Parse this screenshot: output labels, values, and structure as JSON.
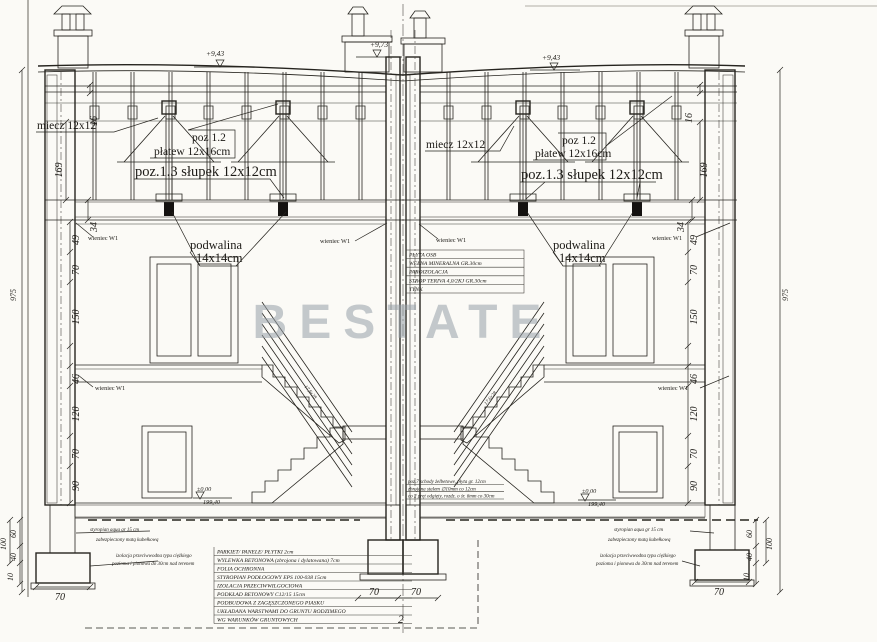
{
  "watermark": "BESTATE",
  "axis_label": "2",
  "levels": {
    "ridge": "+9,73",
    "eaves": "+9,43",
    "zero": "±0,00",
    "datum": "199,40"
  },
  "roof": {
    "miecz": "miecz 12x12",
    "poz": "poz 1.2",
    "platew": "płatew 12x16cm",
    "slupek": "poz.1.3 słupek 12x12cm"
  },
  "walls": {
    "podwalina": "podwalina",
    "podwalina_size": "14x14cm",
    "wieniec": "wieniec W1"
  },
  "ceiling_table": {
    "rows": [
      "PŁYTA OSB",
      "WEŁNA MINERALNA  GR.30cm",
      "PAROIZOLACJA",
      "STROP TERIVA 4,0/2KJ  GR.30cm",
      "TYNK"
    ]
  },
  "floor_table": {
    "rows": [
      "PARKIET/ PANELE/ PŁYTKI  2cm",
      "WYLEWKA BETONOWA (zbrojona i dylatowana) 7cm",
      "FOLIA OCHRONNA",
      "STYROPIAN PODŁOGOWY EPS 100-038  15cm",
      "IZOLACJA PRZECIWWILGOCIOWA",
      "PODKŁAD BETONOWY C12/15  15cm",
      "PODBUDOWA Z ZAGĘSZCZONEGO PIASKU",
      "UKŁADANA WARSTWAMI DO GRUNTU RODZIMEGO",
      "WG WARUNKÓW GRUNTOWYCH"
    ]
  },
  "stairs_note": {
    "lines": [
      "poz.7 schody żelbetowe, płyta gr. 12cm",
      "zbrojona stalem ∅10mm co 12cm",
      "co 2 pręt odgięty, rozdz. o śr. 6mm co 30cm"
    ]
  },
  "stair_step_dim": "17,6x28",
  "foundation_notes": {
    "styro1": "styropian aqua gr 15 cm",
    "styro2": "zabezpieczony matą kubełkową",
    "izo1": "izolacja przeciwwodna typu ciężkiego",
    "izo2": "pozioma i pionowa do 30cm nad terenem"
  },
  "dims": {
    "overall": "975",
    "roof_thickness": "16",
    "knee_wall": "169",
    "attic_floor": "34",
    "left_chain": [
      "49",
      "70",
      "150",
      "46",
      "120",
      "70",
      "90"
    ],
    "right_chain": [
      "49",
      "70",
      "150",
      "46",
      "120",
      "70",
      "90"
    ],
    "footing_total": "100",
    "footing_depth": [
      "60",
      "40",
      "10"
    ],
    "footing_width": "70",
    "center_footing": [
      "70",
      "70"
    ]
  }
}
